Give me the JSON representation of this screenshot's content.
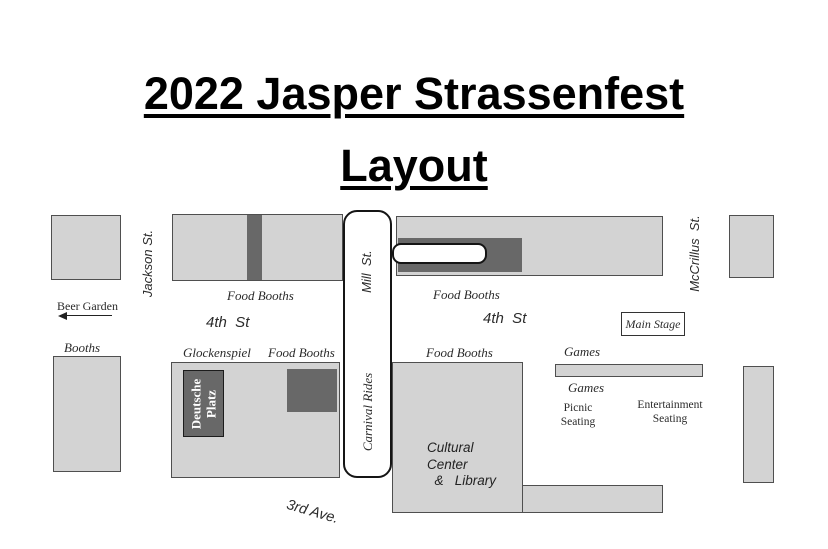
{
  "title": {
    "line1": "2022 Jasper Strassenfest",
    "line2": "Layout"
  },
  "streets": {
    "jackson": "Jackson St.",
    "mill": "Mill  St.",
    "carnival_rides": "Carnival Rides",
    "mccrillus": "McCrillus  St.",
    "fourth_west": "4th  St",
    "fourth_east": "4th  St",
    "third_ave": "3rd Ave."
  },
  "areas": {
    "beer_garden": "Beer Garden",
    "booths": "Booths",
    "food_booths_nw": "Food Booths",
    "food_booths_ne": "Food Booths",
    "food_booths_sw": "Food Booths",
    "food_booths_se": "Food Booths",
    "glockenspiel": "Glockenspiel",
    "deutsche_platz": "Deutsche\nPlatz",
    "cultural_center": "Cultural\nCenter\n  &   Library",
    "main_stage": "Main Stage",
    "games_north": "Games",
    "games_south": "Games",
    "picnic_seating": "Picnic\nSeating",
    "entertainment_seating": "Entertainment\nSeating"
  },
  "colors": {
    "block_fill": "#d3d3d3",
    "block_border": "#4f4f4f",
    "dark_fill": "#686868",
    "street_fill": "#ffffff",
    "street_border": "#151515",
    "background": "#ffffff",
    "text": "#2b2b2b"
  }
}
